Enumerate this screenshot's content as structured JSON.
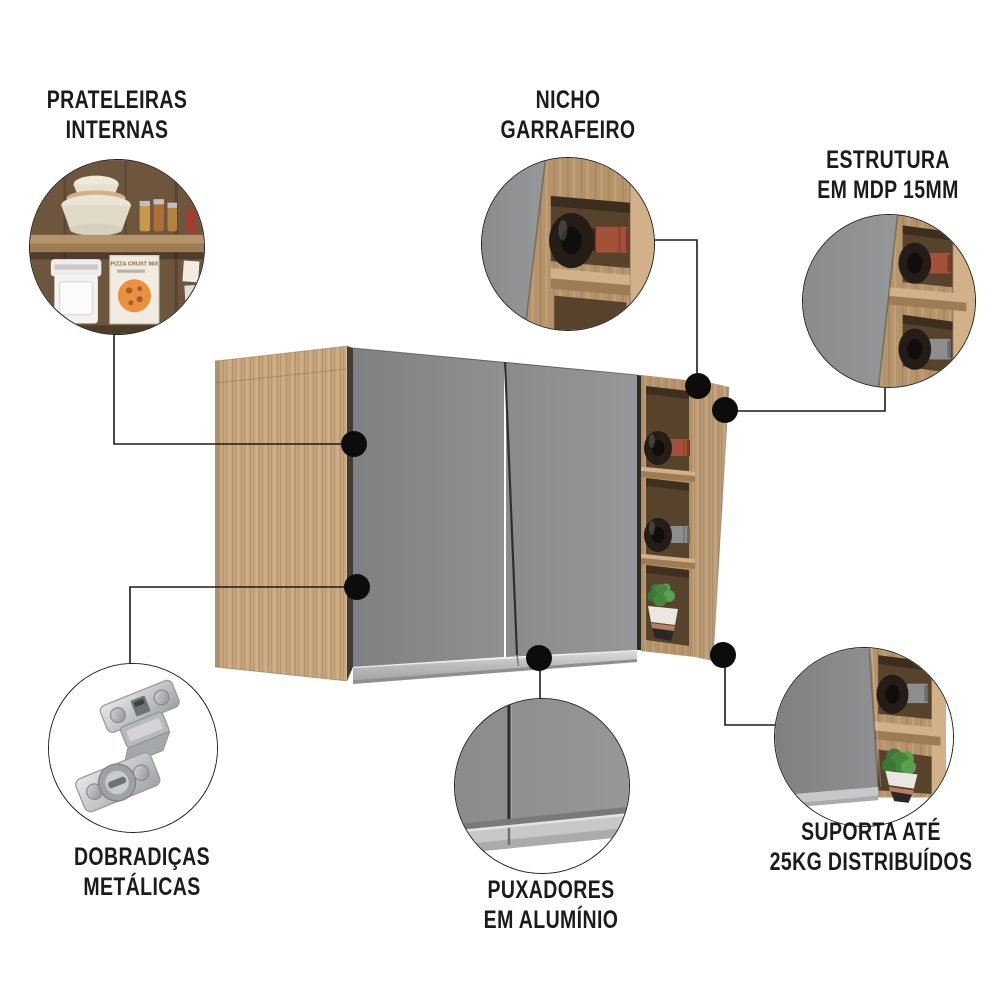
{
  "page": {
    "background": "#ffffff",
    "description": "product infographic of a kitchen wall cabinet with annotated features"
  },
  "colors": {
    "page_bg": "#ffffff",
    "text": "#1b1b1b",
    "line": "#1a1a1a",
    "dot": "#0c0c0c",
    "door_gray": "#8b8d8f",
    "aluminum": "#c0c2c4",
    "wood": "#c7a67e",
    "wood_mid": "#b6946b",
    "wood_dark": "#9c7b55",
    "wood_light": "#d2b189",
    "wood_interior": "#57422c",
    "photo_wood_back": "#6e553d",
    "bottle_dark": "#231c17",
    "cap_red": "#a4513a",
    "cap_gray": "#8d8d8d",
    "plant_green": "#47863f",
    "plant_green_dark": "#3c7736",
    "plant_green_light": "#5aa04f",
    "pot_white": "#e9e7e1",
    "bowl_dark": "#2b2724",
    "copper": "#b87f60",
    "hinge_silver": "#c9ccce"
  },
  "callouts": [
    {
      "id": "prateleiras-internas",
      "line1": "PRATELEIRAS",
      "line2": "INTERNAS",
      "image": "internal-shelves-photo"
    },
    {
      "id": "nicho-garrafeiro",
      "line1": "NICHO",
      "line2": "GARRAFEIRO",
      "image": "wine-niche-photo"
    },
    {
      "id": "estrutura-mdp",
      "line1": "ESTRUTURA",
      "line2": "EM MDP 15MM",
      "image": "mdp-structure-photo"
    },
    {
      "id": "dobradicas-metalicas",
      "line1": "DOBRADIÇAS",
      "line2": "METÁLICAS",
      "image": "metal-hinge-photo"
    },
    {
      "id": "puxadores-aluminio",
      "line1": "PUXADORES",
      "line2": "EM ALUMÍNIO",
      "image": "aluminum-handle-photo"
    },
    {
      "id": "suporta-25kg",
      "line1": "SUPORTA ATÉ",
      "line2": "25KG DISTRIBUÍDOS",
      "image": "weight-capacity-photo"
    }
  ],
  "photo_details": {
    "pizza_box_text": "PIZZA CRUST MIX"
  }
}
